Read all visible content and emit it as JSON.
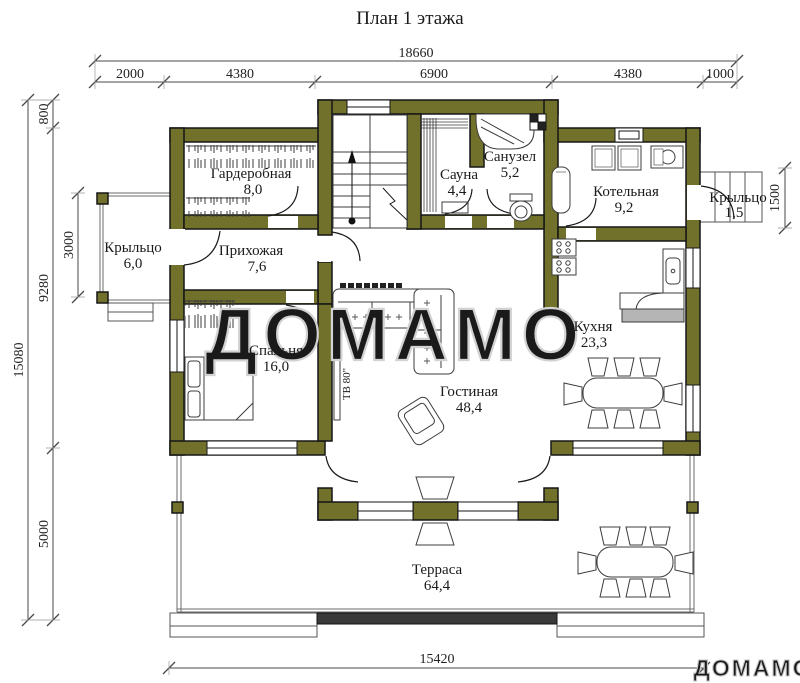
{
  "title": "План 1 этажа",
  "watermark": {
    "center": "ДОМАМО",
    "corner": "ДОМАМО"
  },
  "colors": {
    "wall": "#71712c",
    "outline": "#161616",
    "dim_line": "#4a4a4a",
    "watermark": "#d2d2d2"
  },
  "dimensions": {
    "top": {
      "total": "18660",
      "segments": [
        "2000",
        "4380",
        "6900",
        "4380",
        "1000"
      ]
    },
    "left": {
      "overall": "15080",
      "top_offset": "800",
      "middle": "9280",
      "bottom": "5000",
      "porch_depth": "3000"
    },
    "right": {
      "porch_depth": "1500"
    },
    "bottom": {
      "width": "15420"
    }
  },
  "rooms": {
    "garderobnaya": {
      "name": "Гардеробная",
      "area": "8,0"
    },
    "sauna": {
      "name": "Сауна",
      "area": "4,4"
    },
    "sanuzel": {
      "name": "Санузел",
      "area": "5,2"
    },
    "kotelnaya": {
      "name": "Котельная",
      "area": "9,2"
    },
    "porch_right": {
      "name": "Крыльцо",
      "area": "1,5"
    },
    "porch_left": {
      "name": "Крыльцо",
      "area": "6,0"
    },
    "prihozhaya": {
      "name": "Прихожая",
      "area": "7,6"
    },
    "spalnya": {
      "name": "Спальня",
      "area": "16,0"
    },
    "kuhnya": {
      "name": "Кухня",
      "area": "23,3"
    },
    "gostinaya": {
      "name": "Гостиная",
      "area": "48,4"
    },
    "terrasa": {
      "name": "Терраса",
      "area": "64,4"
    }
  },
  "annotations": {
    "tv": "ТВ 80\""
  }
}
